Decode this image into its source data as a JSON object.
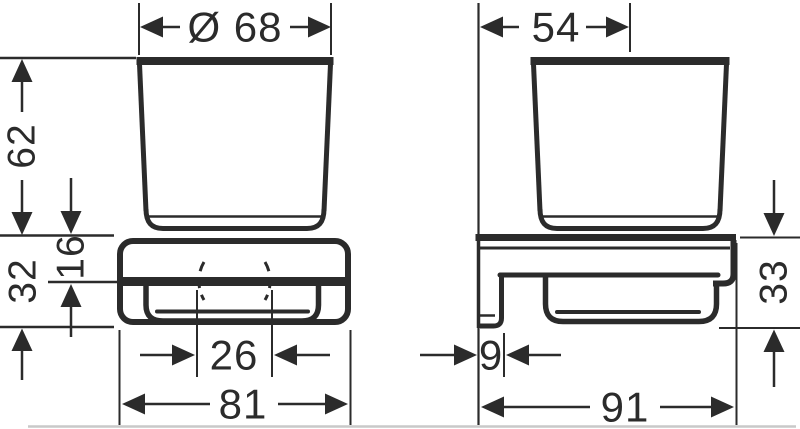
{
  "colors": {
    "ink": "#2b2b2b",
    "baseline": "#c9c9c9",
    "background": "#ffffff"
  },
  "dimensions": {
    "glass_diameter": "Ø 68",
    "wall_to_axis_depth": "54",
    "glass_height": "62",
    "holder_front_height": "32",
    "rim_to_shelf": "16",
    "hole_spacing": "26",
    "overall_width": "81",
    "bracket_thickness": "9",
    "overall_depth": "91",
    "bracket_side_height": "33"
  }
}
